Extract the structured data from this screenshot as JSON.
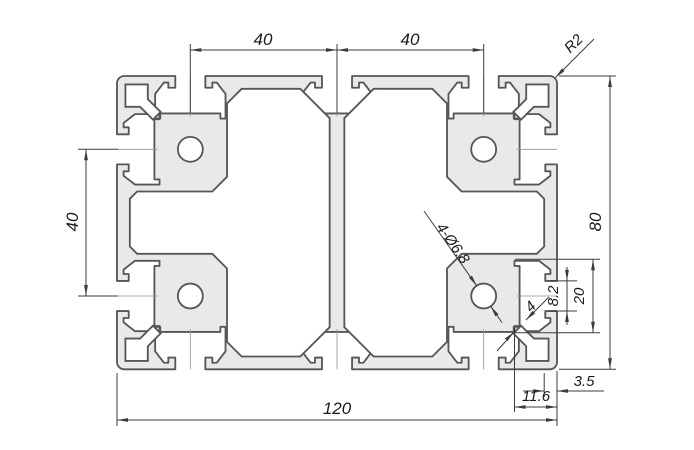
{
  "drawing": {
    "colors": {
      "background": "#ffffff",
      "body_fill": "#e8eae9",
      "cavity_fill": "#ffffff",
      "outline": "#54575a",
      "dim_line": "#3c3c3c",
      "centerline": "#8f9391",
      "text": "#1b1b1b"
    },
    "dims": {
      "top_pitch_left": "40",
      "top_pitch_right": "40",
      "side_pitch": "40",
      "height": "80",
      "width": "120",
      "corner_radius": "R2",
      "holes": "4-Ø6.8",
      "slot_opening": "8.2",
      "slot_width": "20",
      "wall_thickness": "4",
      "outer_wall": "3.5",
      "slot_depth": "11.6"
    }
  }
}
